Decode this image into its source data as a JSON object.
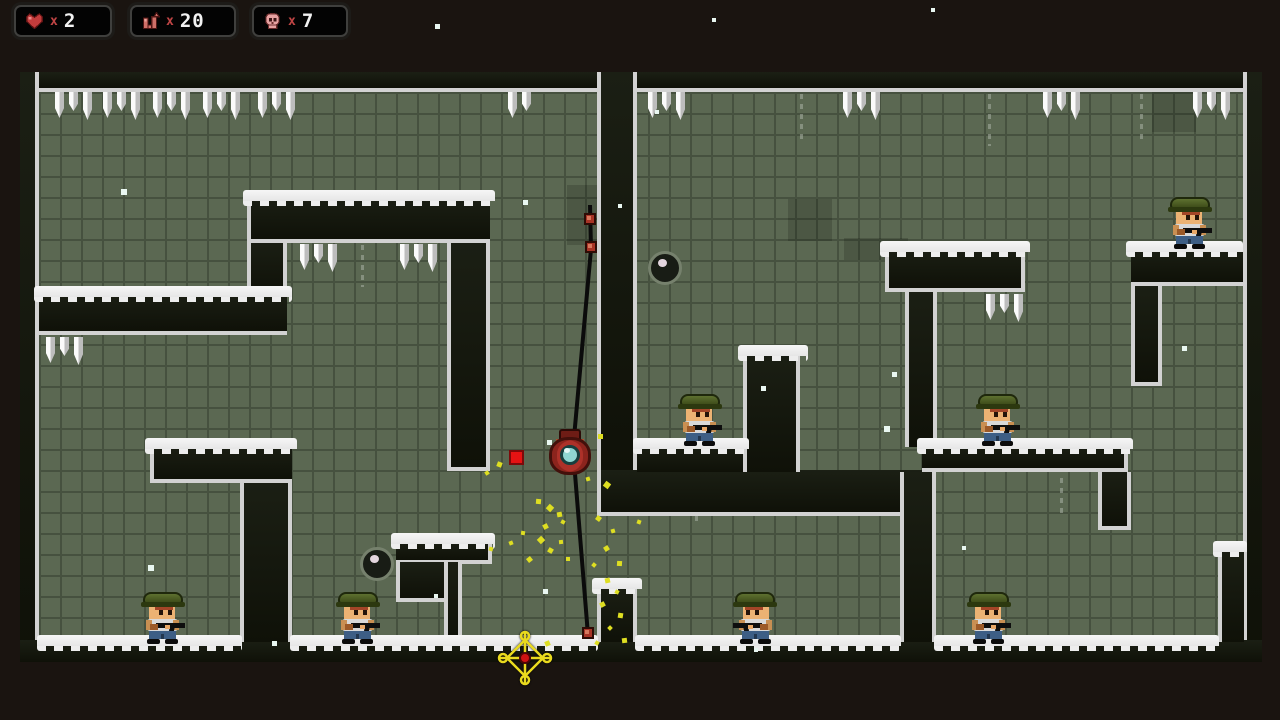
{
  "hud": {
    "lives": {
      "icon": "heart-icon",
      "multiplier": "x",
      "value": "2"
    },
    "ammo": {
      "icon": "gun-icon",
      "multiplier": "x",
      "value": "20"
    },
    "enemies": {
      "icon": "skull-icon",
      "multiplier": "x",
      "value": "7"
    }
  },
  "colors": {
    "outside_bg": "#1a1410",
    "tile": "#5b6852",
    "tile_grout": "#46513f",
    "wall": "#14170e",
    "wall_edge": "#d2d2d2",
    "snow": "#f2f2f2",
    "soldier_helmet": "#4a5a23",
    "player_body": "#ad3129",
    "player_eye": "#8fd6d2",
    "rope": "#0b0b0b",
    "projectile": "#e51313",
    "crosshair": "#e9da1e",
    "particle_yellow": "#dede22",
    "hud_text": "#f2f2f2",
    "hud_x": "#c04545"
  },
  "level": {
    "bounds": {
      "x": 20,
      "y": 72,
      "w": 1242,
      "h": 590
    },
    "walls": [
      {
        "name": "outer-top",
        "x": 20,
        "y": 72,
        "w": 1242,
        "h": 20,
        "b": "B"
      },
      {
        "name": "outer-left",
        "x": 20,
        "y": 72,
        "w": 19,
        "h": 590,
        "b": "R"
      },
      {
        "name": "outer-right",
        "x": 1243,
        "y": 72,
        "w": 19,
        "h": 590,
        "b": "L"
      },
      {
        "name": "outer-bottom",
        "x": 20,
        "y": 640,
        "w": 1242,
        "h": 22,
        "b": ""
      },
      {
        "name": "ledge-left",
        "x": 39,
        "y": 293,
        "w": 248,
        "h": 42,
        "b": "B"
      },
      {
        "name": "col-topleft",
        "x": 247,
        "y": 241,
        "w": 40,
        "h": 54,
        "b": "LR"
      },
      {
        "name": "bar-topleft",
        "x": 247,
        "y": 197,
        "w": 243,
        "h": 46,
        "b": "LB"
      },
      {
        "name": "leg-topleft",
        "x": 447,
        "y": 243,
        "w": 43,
        "h": 228,
        "b": "LRB"
      },
      {
        "name": "bar-bottomleft",
        "x": 150,
        "y": 445,
        "w": 142,
        "h": 38,
        "b": "LB"
      },
      {
        "name": "leg-bottomleft",
        "x": 240,
        "y": 483,
        "w": 52,
        "h": 159,
        "b": "LR"
      },
      {
        "name": "stair-mid",
        "x": 396,
        "y": 540,
        "w": 96,
        "h": 24,
        "b": "RB"
      },
      {
        "name": "stair-leg",
        "x": 396,
        "y": 562,
        "w": 48,
        "h": 40,
        "b": "LB"
      },
      {
        "name": "stair-col",
        "x": 444,
        "y": 562,
        "w": 18,
        "h": 80,
        "b": "LR"
      },
      {
        "name": "divider-top",
        "x": 597,
        "y": 72,
        "w": 40,
        "h": 400,
        "b": "LR"
      },
      {
        "name": "u-bottom",
        "x": 597,
        "y": 470,
        "w": 339,
        "h": 46,
        "b": "LB"
      },
      {
        "name": "u-ledge",
        "x": 637,
        "y": 445,
        "w": 106,
        "h": 27,
        "b": ""
      },
      {
        "name": "u-tower",
        "x": 743,
        "y": 352,
        "w": 57,
        "h": 120,
        "b": "LR"
      },
      {
        "name": "pillar-bottom",
        "x": 597,
        "y": 585,
        "w": 40,
        "h": 57,
        "b": "LR"
      },
      {
        "name": "wall-bottom-mid",
        "x": 900,
        "y": 472,
        "w": 36,
        "h": 170,
        "b": "LR"
      },
      {
        "name": "col-right-top",
        "x": 905,
        "y": 290,
        "w": 32,
        "h": 157,
        "b": "LR"
      },
      {
        "name": "bar-right-top",
        "x": 885,
        "y": 248,
        "w": 140,
        "h": 44,
        "b": "LRB"
      },
      {
        "name": "plat-right-mid",
        "x": 922,
        "y": 445,
        "w": 206,
        "h": 27,
        "b": "RB"
      },
      {
        "name": "leg-right-mid",
        "x": 1098,
        "y": 472,
        "w": 33,
        "h": 58,
        "b": "LRB"
      },
      {
        "name": "bar-topright",
        "x": 1131,
        "y": 248,
        "w": 112,
        "h": 38,
        "b": "B"
      },
      {
        "name": "leg-topright",
        "x": 1131,
        "y": 286,
        "w": 31,
        "h": 100,
        "b": "LRB"
      },
      {
        "name": "block-bottomright",
        "x": 1218,
        "y": 548,
        "w": 26,
        "h": 94,
        "b": "L"
      }
    ],
    "snow": [
      [
        34,
        286,
        258
      ],
      [
        243,
        190,
        252
      ],
      [
        145,
        438,
        152
      ],
      [
        391,
        533,
        104
      ],
      [
        633,
        438,
        116
      ],
      [
        738,
        345,
        70
      ],
      [
        592,
        578,
        50
      ],
      [
        917,
        438,
        216
      ],
      [
        880,
        241,
        150
      ],
      [
        1126,
        241,
        117
      ],
      [
        1213,
        541,
        34
      ],
      [
        37,
        635,
        205
      ],
      [
        290,
        635,
        308
      ],
      [
        635,
        635,
        266
      ],
      [
        934,
        635,
        285
      ]
    ],
    "icicle_groups": [
      {
        "x": 55,
        "y": 92,
        "n": 3
      },
      {
        "x": 103,
        "y": 92,
        "n": 3
      },
      {
        "x": 153,
        "y": 92,
        "n": 3
      },
      {
        "x": 203,
        "y": 92,
        "n": 3
      },
      {
        "x": 258,
        "y": 92,
        "n": 3
      },
      {
        "x": 508,
        "y": 92,
        "n": 2
      },
      {
        "x": 648,
        "y": 92,
        "n": 3
      },
      {
        "x": 843,
        "y": 92,
        "n": 3
      },
      {
        "x": 1043,
        "y": 92,
        "n": 3
      },
      {
        "x": 1193,
        "y": 92,
        "n": 3
      },
      {
        "x": 300,
        "y": 244,
        "n": 3
      },
      {
        "x": 400,
        "y": 244,
        "n": 3
      },
      {
        "x": 46,
        "y": 337,
        "n": 3
      },
      {
        "x": 986,
        "y": 294,
        "n": 3
      }
    ],
    "cracks": [
      [
        800,
        94,
        48
      ],
      [
        988,
        94,
        52
      ],
      [
        1140,
        94,
        46
      ],
      [
        361,
        245,
        42
      ],
      [
        695,
        486,
        40
      ],
      [
        1060,
        478,
        40
      ]
    ],
    "dark_patches": [
      [
        567,
        185,
        70,
        60
      ],
      [
        788,
        199,
        44,
        42
      ],
      [
        844,
        238,
        64,
        22
      ],
      [
        1152,
        92,
        44,
        40
      ]
    ]
  },
  "entities": {
    "soldiers": [
      {
        "x": 163,
        "y": 642,
        "facing": "right"
      },
      {
        "x": 358,
        "y": 642,
        "facing": "right"
      },
      {
        "x": 700,
        "y": 444,
        "facing": "right"
      },
      {
        "x": 755,
        "y": 642,
        "facing": "left"
      },
      {
        "x": 989,
        "y": 642,
        "facing": "right"
      },
      {
        "x": 998,
        "y": 444,
        "facing": "right"
      },
      {
        "x": 1190,
        "y": 247,
        "facing": "right"
      }
    ],
    "bombs": [
      {
        "x": 665,
        "y": 268
      },
      {
        "x": 377,
        "y": 564
      }
    ],
    "player": {
      "x": 570,
      "y": 453
    },
    "rope": {
      "points": [
        [
          590,
          205
        ],
        [
          591,
          249
        ],
        [
          573,
          449
        ],
        [
          588,
          635
        ]
      ],
      "knobs": [
        [
          590,
          219
        ],
        [
          591,
          247
        ],
        [
          588,
          633
        ]
      ]
    },
    "projectiles": [
      {
        "x": 516,
        "y": 457,
        "s": 15
      }
    ],
    "crosshair": {
      "x": 525,
      "y": 658
    }
  },
  "particles": {
    "yellow": [
      [
        598,
        434,
        5
      ],
      [
        604,
        482,
        6
      ],
      [
        586,
        477,
        4
      ],
      [
        497,
        462,
        5
      ],
      [
        485,
        471,
        4
      ],
      [
        536,
        499,
        5
      ],
      [
        547,
        505,
        6
      ],
      [
        557,
        512,
        5
      ],
      [
        561,
        520,
        4
      ],
      [
        543,
        524,
        5
      ],
      [
        521,
        531,
        4
      ],
      [
        538,
        537,
        6
      ],
      [
        559,
        540,
        4
      ],
      [
        548,
        548,
        5
      ],
      [
        509,
        541,
        4
      ],
      [
        489,
        547,
        4
      ],
      [
        527,
        557,
        5
      ],
      [
        566,
        557,
        4
      ],
      [
        596,
        516,
        5
      ],
      [
        611,
        529,
        4
      ],
      [
        637,
        520,
        4
      ],
      [
        604,
        546,
        5
      ],
      [
        617,
        561,
        5
      ],
      [
        592,
        563,
        4
      ],
      [
        605,
        578,
        5
      ],
      [
        615,
        590,
        4
      ],
      [
        600,
        602,
        5
      ],
      [
        618,
        613,
        5
      ],
      [
        608,
        626,
        4
      ],
      [
        622,
        638,
        5
      ],
      [
        595,
        641,
        4
      ],
      [
        545,
        641,
        5
      ]
    ],
    "white": [
      [
        435,
        24,
        5
      ],
      [
        712,
        18,
        4
      ],
      [
        931,
        8,
        4
      ],
      [
        121,
        189,
        6
      ],
      [
        523,
        200,
        5
      ],
      [
        618,
        204,
        4
      ],
      [
        655,
        110,
        4
      ],
      [
        547,
        440,
        5
      ],
      [
        761,
        386,
        5
      ],
      [
        892,
        372,
        5
      ],
      [
        884,
        426,
        6
      ],
      [
        1182,
        346,
        5
      ],
      [
        148,
        565,
        6
      ],
      [
        543,
        589,
        5
      ],
      [
        434,
        594,
        4
      ],
      [
        272,
        641,
        5
      ],
      [
        754,
        648,
        4
      ],
      [
        962,
        546,
        4
      ]
    ]
  }
}
